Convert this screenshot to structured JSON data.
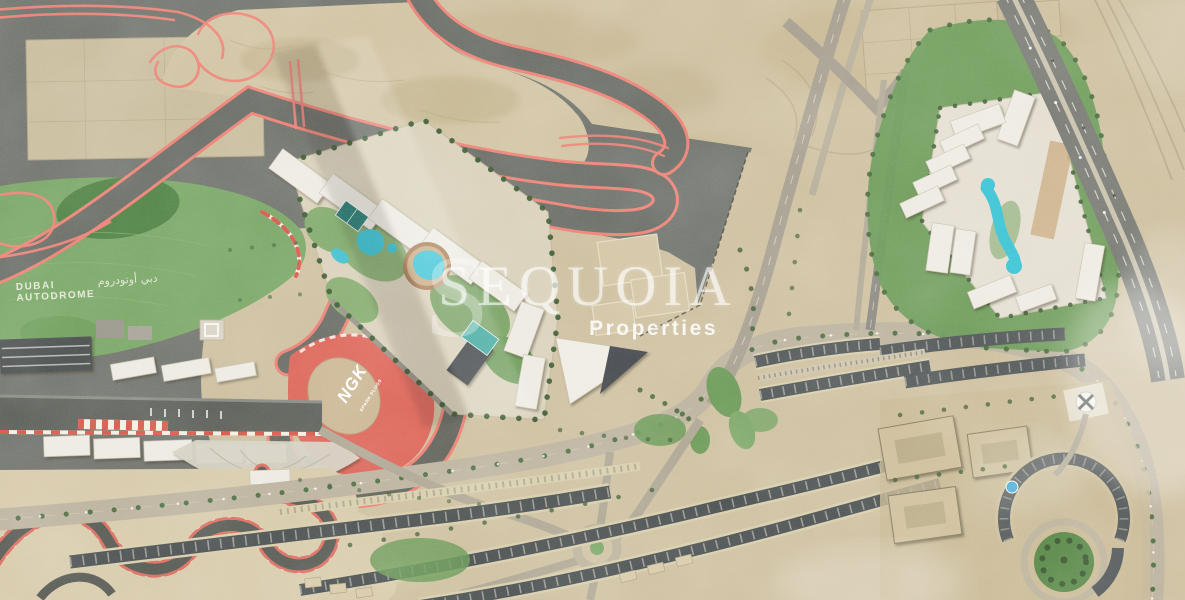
{
  "image": {
    "alt": "Aerial satellite photograph of Dubai Autodrome race circuit and surrounding residential communities with developer watermark",
    "width": 1185,
    "height": 600
  },
  "watermark": {
    "logo_s": "S",
    "brand": "SEQUOIA",
    "tagline": "Properties",
    "color": "#ffffff"
  },
  "track_labels": {
    "autodrome_line1": "DUBAI",
    "autodrome_line2": "AUTODROME",
    "autodrome_arabic": "دبي أوتودروم",
    "ngk_brand": "NGK",
    "ngk_sub": "SPARK PLUGS"
  },
  "palette": {
    "sand": "#cfc1a1",
    "sand_dark": "#b7a883",
    "asphalt": "#73756f",
    "track_red": "#ee8276",
    "ngk_red": "#dd685c",
    "grass": "#7ba768",
    "grass_dark": "#4e7f44",
    "pool_water": "#3fc5d6",
    "building_white": "#edeae2",
    "roof_dark": "#53585a",
    "road": "#bdb4a0",
    "highway": "#7b7d76",
    "tree": "#46633c",
    "white": "#ffffff"
  },
  "features": {
    "race_track": "Dubai Autodrome circuit",
    "kartdrome": "Kartdrome winding track",
    "pit_buildings": "Pit and paddock buildings",
    "grandstand": "Grandstand",
    "helipad": "Helipad",
    "infield": "Green infield with Dubai Autodrome lettering",
    "ngk_curve": "NGK branded run-off curve",
    "center_development": "Central residential development with circular pool",
    "right_development": "Triangular residential development with lagoon pool",
    "construction_site": "Construction site",
    "residential_south": "Curved apartment rows along boulevard",
    "residential_east": "Residential community with circular park",
    "boulevard": "Tree-lined boulevard",
    "highway": "Multi-lane highway with rail corridor",
    "desert": "Desert terrain with plot outlines",
    "compass_marker": "Circular plaza marker with cross",
    "roundabout": "Roundabout",
    "green_park": "Circular green park",
    "light_streak": "Diagonal light streak",
    "haze": "Atmospheric haze"
  }
}
